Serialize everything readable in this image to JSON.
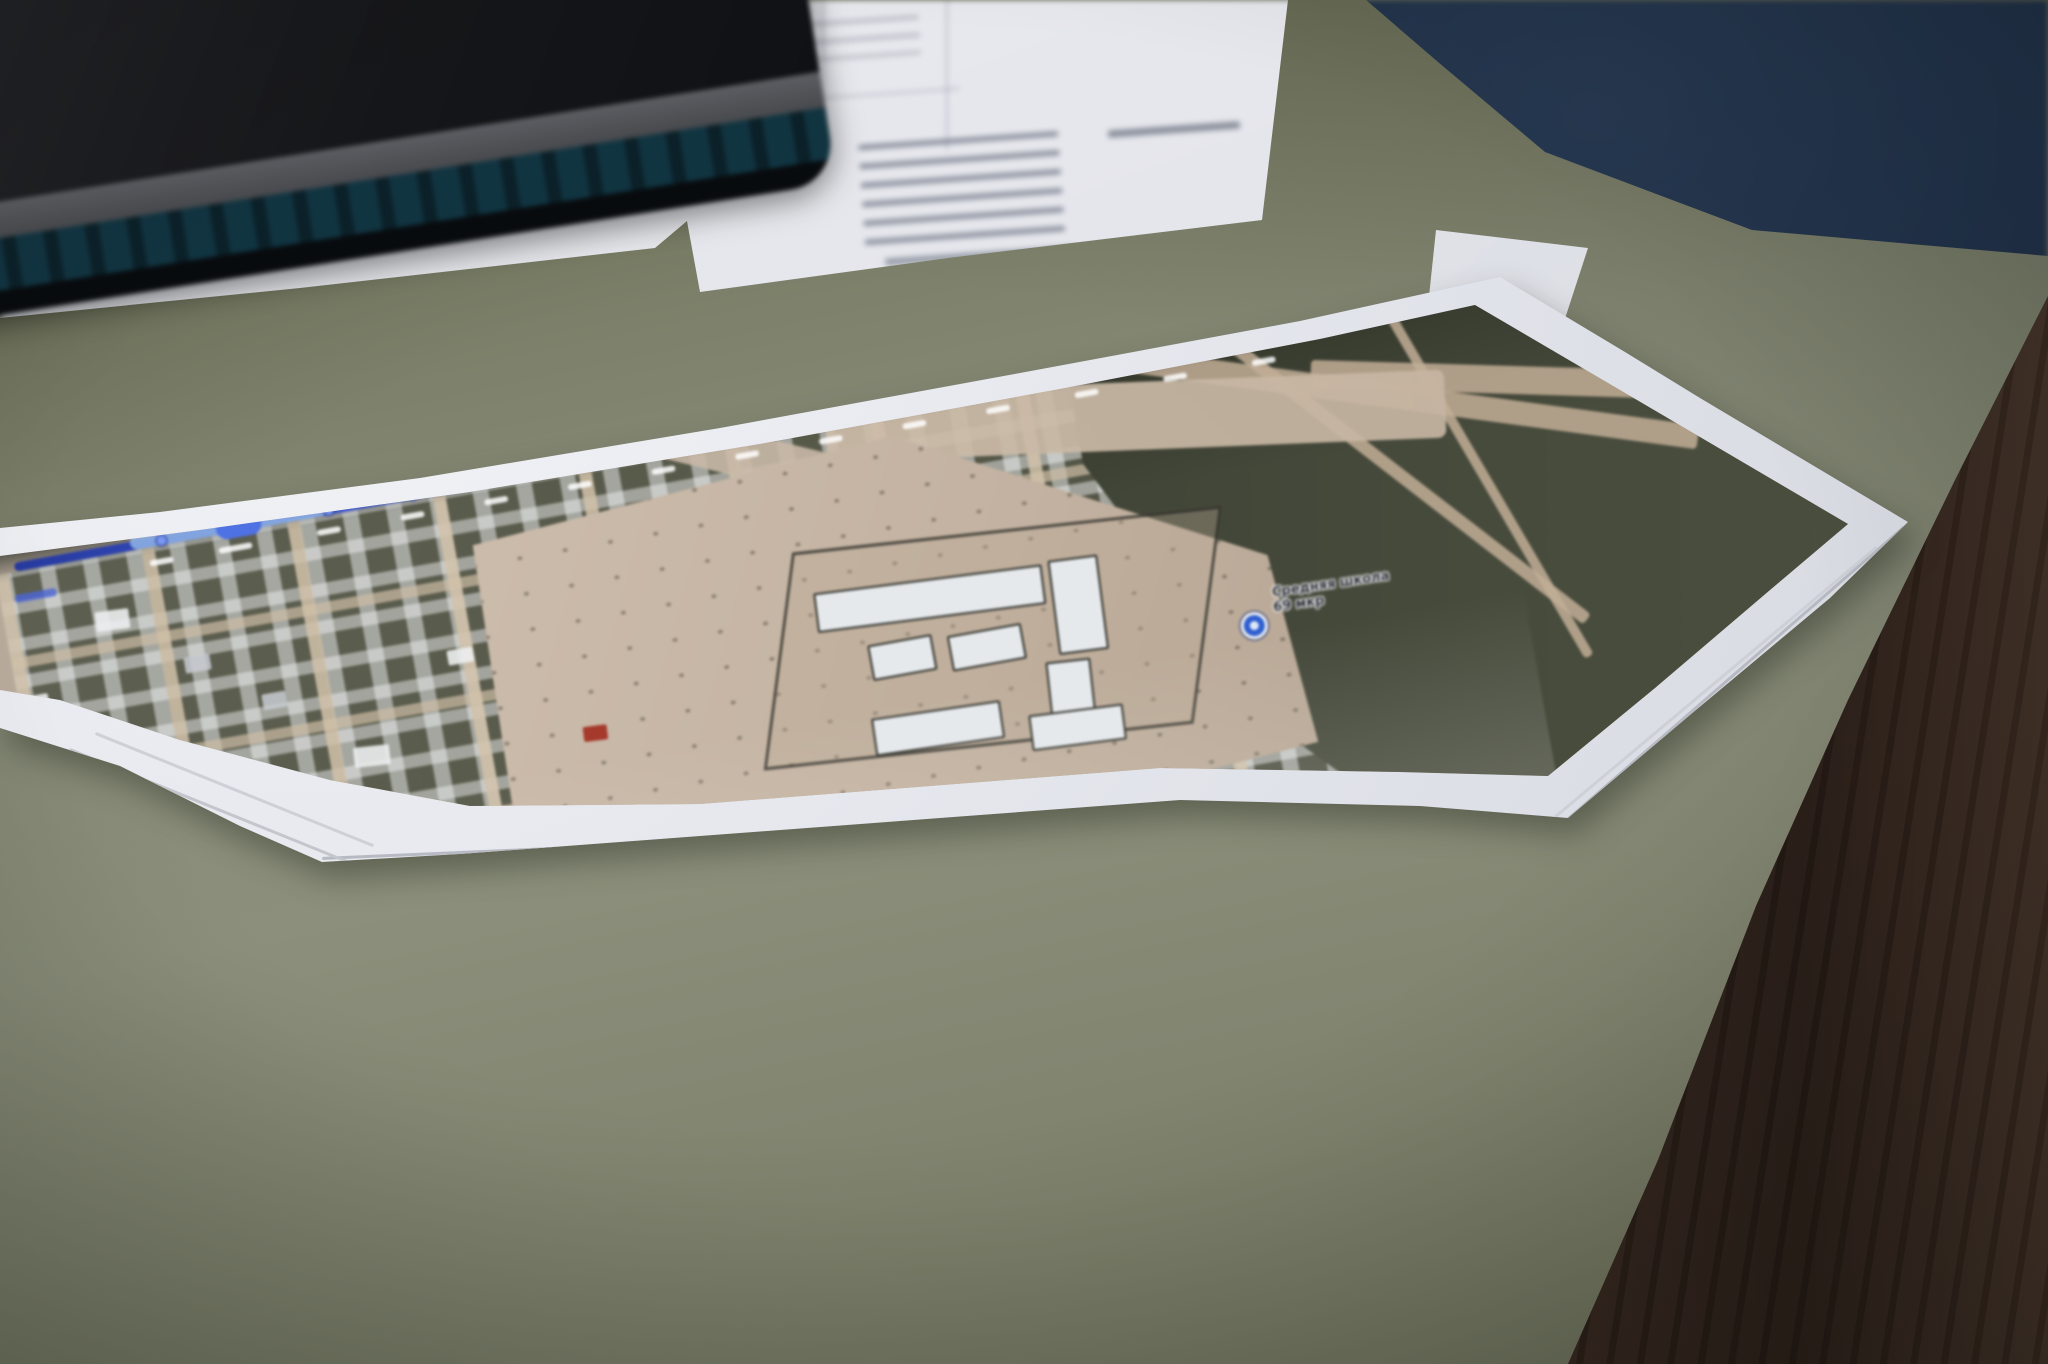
{
  "scene": {
    "type": "photograph",
    "description": "Close-up photo of a stack of printed satellite-map pages lying on an olive-green desk pad; above are an out-of-focus white document with a faint table, a dark closed laptop with a teal edge stripe, a dark navy bag in the top-right corner, and a dark wooden desk edge along the right side.",
    "objects": [
      "printed-satellite-map-stack",
      "white-document",
      "white-paper-under-laptop",
      "dark-laptop",
      "navy-bag",
      "paper-corner",
      "desk-pad",
      "wooden-desk-edge"
    ]
  },
  "map_print": {
    "poi_label_line1": "Средняя школа",
    "poi_label_line2": "69 мкр",
    "route": {
      "color": "#3f58d6",
      "node_count": 14,
      "node_labels_legible": false,
      "description": "Blue measured route line with node dots and tiny white distance labels running along the top of the printed map"
    },
    "regions": [
      "dense residential grid with white roofs",
      "large tan vacant lot",
      "school compound with white buildings and blue POI pin",
      "dark green fields with branching dirt roads"
    ],
    "stacked_sheets_visible": 4
  },
  "colors": {
    "desk_pad": "#868a76",
    "wood": "#4e3b30",
    "wood_dark_strip": "#2e211b",
    "paper": "#e4e5ea",
    "map_ground": "#c3b3a3",
    "map_dark_field": "#44483a",
    "map_housing": "#585a4c",
    "route_blue": "#3f58d6",
    "route_highlight": "#8fb4e6",
    "poi_blue": "#2f5fd0",
    "laptop_teal": "#123642",
    "navy_bag": "#16233a",
    "red_roof": "#a5392c"
  }
}
